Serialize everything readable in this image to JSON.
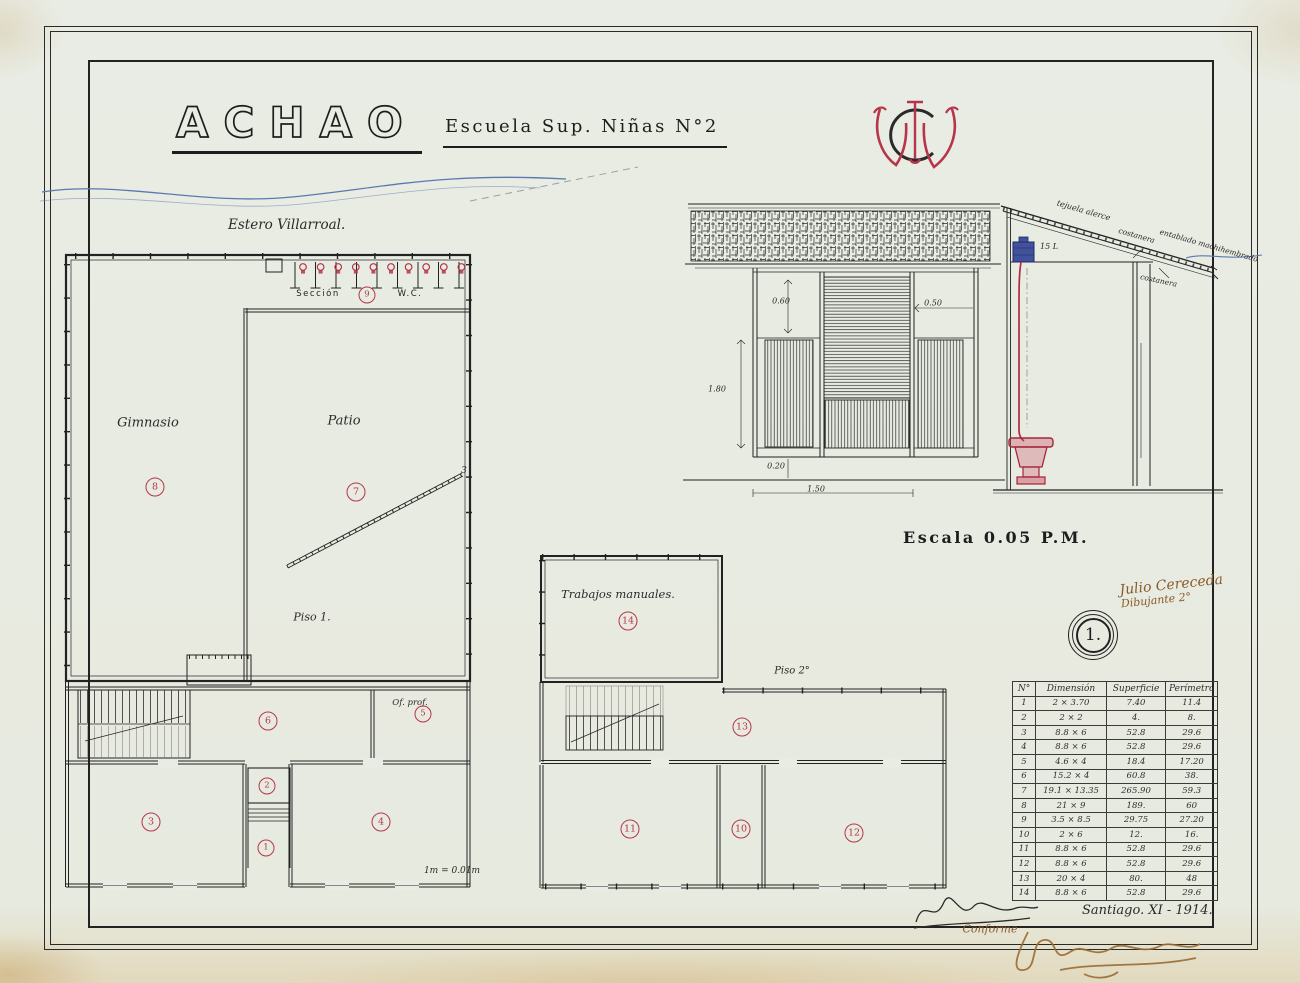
{
  "sheet": {
    "title": "ACHAO",
    "subtitle": "Escuela Sup. Niñas N°2",
    "monogram": "WC",
    "river_label": "Estero Villarroal.",
    "scale_label": "Escala 0.05 P.M.",
    "sheet_number": "1.",
    "plan_scale_note": "1m = 0.01m",
    "date": "Santiago. XI - 1914.",
    "conforme": "Conforme",
    "drafter_line1": "Julio Cereceda",
    "drafter_line2": "Dibujante 2°"
  },
  "plan1": {
    "floor_label": "Piso 1.",
    "rooms": {
      "gimnasio": {
        "label": "Gimnasio",
        "number": "8"
      },
      "patio": {
        "label": "Patio",
        "number": "7"
      },
      "wc_section": {
        "label_left": "Sección",
        "number": "9",
        "label_right": "W.C."
      },
      "corridor": {
        "number": "6"
      },
      "office": {
        "label": "Of. prof.",
        "number": "5"
      },
      "vestibule": {
        "number": "2"
      },
      "entrance": {
        "number": "1"
      },
      "classroom_left": {
        "number": "3"
      },
      "classroom_right": {
        "number": "4"
      }
    },
    "annotations": {
      "diagonal_end": "3"
    }
  },
  "plan2": {
    "floor_label": "Piso 2°",
    "rooms": {
      "manual_works": {
        "label": "Trabajos manuales.",
        "number": "14"
      },
      "corridor": {
        "number": "13"
      },
      "room_left": {
        "number": "11"
      },
      "room_middle": {
        "number": "10"
      },
      "room_right": {
        "number": "12"
      }
    }
  },
  "wc_elevation": {
    "dims": {
      "d1": "0.60",
      "d2": "0.50",
      "d3": "1.80",
      "d4": "0.20",
      "d5": "1.50"
    }
  },
  "wc_section": {
    "labels": {
      "roof": "tejuela alerce",
      "purlin": "costanera",
      "boarding": "entablado machihembrado",
      "purlin2": "costanera",
      "tank": "15 L"
    }
  },
  "table": {
    "headers": [
      "N°",
      "Dimensión",
      "Superficie",
      "Perímetro"
    ],
    "rows": [
      [
        "1",
        "2 × 3.70",
        "7.40",
        "11.4"
      ],
      [
        "2",
        "2 × 2",
        "4.",
        "8."
      ],
      [
        "3",
        "8.8 × 6",
        "52.8",
        "29.6"
      ],
      [
        "4",
        "8.8 × 6",
        "52.8",
        "29.6"
      ],
      [
        "5",
        "4.6 × 4",
        "18.4",
        "17.20"
      ],
      [
        "6",
        "15.2 × 4",
        "60.8",
        "38."
      ],
      [
        "7",
        "19.1 × 13.35",
        "265.90",
        "59.3"
      ],
      [
        "8",
        "21 × 9",
        "189.",
        "60"
      ],
      [
        "9",
        "3.5 × 8.5",
        "29.75",
        "27.20"
      ],
      [
        "10",
        "2 × 6",
        "12.",
        "16."
      ],
      [
        "11",
        "8.8 × 6",
        "52.8",
        "29.6"
      ],
      [
        "12",
        "8.8 × 6",
        "52.8",
        "29.6"
      ],
      [
        "13",
        "20 × 4",
        "80.",
        "48"
      ],
      [
        "14",
        "8.8 × 6",
        "52.8",
        "29.6"
      ]
    ]
  }
}
